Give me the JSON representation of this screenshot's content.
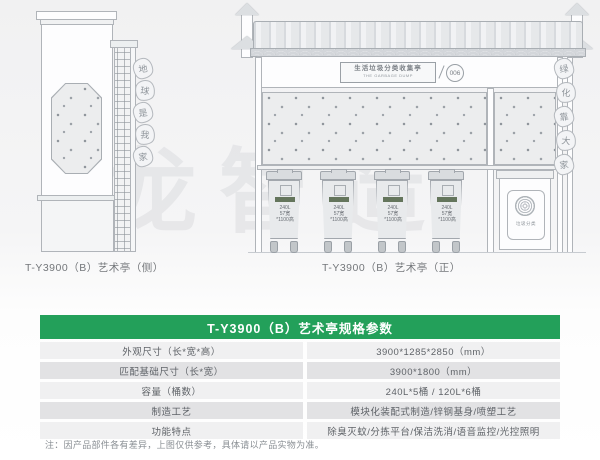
{
  "watermark": "龙智造",
  "side_view": {
    "caption": "T-Y3900（B）艺术亭（侧）",
    "medallions": [
      "地",
      "球",
      "是",
      "我",
      "家"
    ]
  },
  "front_view": {
    "caption": "T-Y3900（B）艺术亭（正）",
    "sign": {
      "title": "生活垃圾分类收集亭",
      "subtitle": "THE GARBAGE DUMP",
      "badge": "006"
    },
    "medallions": [
      "绿",
      "化",
      "靠",
      "大",
      "家"
    ],
    "bin": {
      "l1": "240L",
      "l2": "57宽",
      "l3": "*1100高"
    },
    "logo_text": "垃圾分类"
  },
  "spec_table": {
    "title": "T-Y3900（B）艺术亭规格参数",
    "accent_color": "#23a05a",
    "rows": [
      {
        "label": "外观尺寸（长*宽*高）",
        "value": "3900*1285*2850（mm）"
      },
      {
        "label": "匹配基础尺寸（长*宽）",
        "value": "3900*1800（mm）"
      },
      {
        "label": "容量（桶数）",
        "value": "240L*5桶 / 120L*6桶"
      },
      {
        "label": "制造工艺",
        "value": "模块化装配式制造/锌钢基身/喷塑工艺"
      },
      {
        "label": "功能特点",
        "value": "除臭灭蚊/分拣平台/保洁洗消/语音监控/光控照明"
      }
    ],
    "note": "注：因产品部件各有差异，上图仅供参考，具体请以产品实物为准。"
  }
}
